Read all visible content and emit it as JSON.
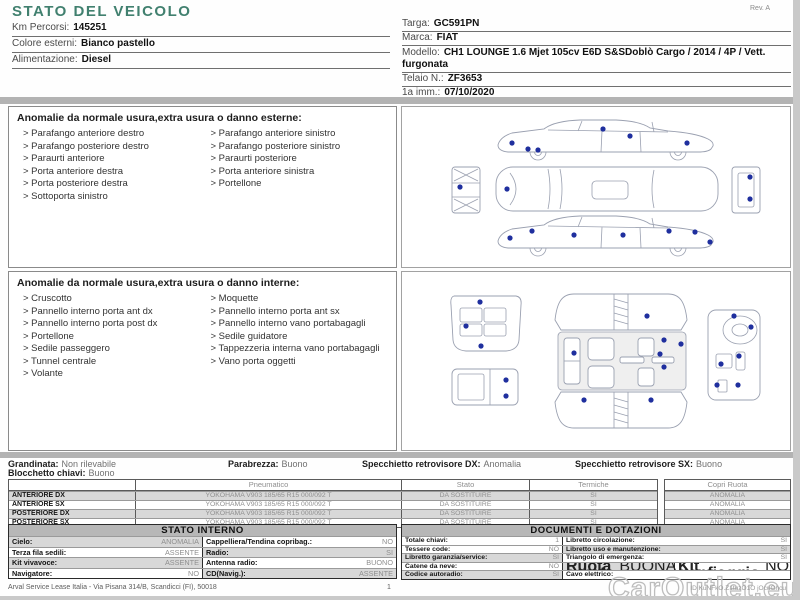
{
  "bullet": ">",
  "title": "STATO DEL VEICOLO",
  "meta": {
    "revision": "Rev. A",
    "footer_company": "Arval Service Lease Italia - Via Pisana 314/B, Scandicci (FI), 50018",
    "page_number": "1",
    "watermark": "CarOutlet.eu",
    "doc_code": "ID KuNFkO.Z1tuzO1O jOcuOhcu"
  },
  "colors": {
    "title_teal": "#41806f",
    "damage_dot": "#1f2f9e",
    "table_header_bg": "#b7b7b7",
    "row_stripe": "#d8d8d8"
  },
  "vehicle_left": [
    {
      "label": "Km Percorsi:",
      "value": "145251"
    },
    {
      "label": "Colore esterni:",
      "value": "Bianco pastello"
    },
    {
      "label": "Alimentazione:",
      "value": "Diesel"
    }
  ],
  "vehicle_right": [
    {
      "label": "Targa:",
      "value": "GC591PN"
    },
    {
      "label": "Marca:",
      "value": "FIAT"
    },
    {
      "label": "Modello:",
      "value": "CH1 LOUNGE 1.6 Mjet 105cv E6D S&SDoblò Cargo / 2014 / 4P / Vett. furgonata"
    },
    {
      "label": "Telaio N.:",
      "value": "ZF3653"
    },
    {
      "label": "1a imm.:",
      "value": "07/10/2020"
    }
  ],
  "exterior_box": {
    "header": "Anomalie da normale usura,extra usura o danno esterne:",
    "left": [
      "Parafango anteriore destro",
      "Parafango posteriore destro",
      "Paraurti anteriore",
      "Porta anteriore destra",
      "Porta posteriore destra",
      "Sottoporta sinistro"
    ],
    "right": [
      "Parafango anteriore sinistro",
      "Parafango posteriore sinistro",
      "Paraurti posteriore",
      "Porta anteriore sinistra",
      "Portellone"
    ]
  },
  "interior_box": {
    "header": "Anomalie da normale usura,extra usura o danno interne:",
    "left": [
      "Cruscotto",
      "Pannello interno porta ant dx",
      "Pannello interno porta post dx",
      "Portellone",
      "Sedile passeggero",
      "Tunnel centrale",
      "Volante"
    ],
    "right": [
      "Moquette",
      "Pannello interno porta ant sx",
      "Pannello interno vano portabagagli",
      "Sedile guidatore",
      "Tappezzeria interna vano portabagagli",
      "Vano porta oggetti"
    ]
  },
  "summary": {
    "grandinata_label": "Grandinata:",
    "grandinata_value": "Non rilevabile",
    "blocchetto_label": "Blocchetto chiavi:",
    "blocchetto_value": "Buono",
    "parabrezza_label": "Parabrezza:",
    "parabrezza_value": "Buono",
    "specchietto_dx_label": "Specchietto retrovisore DX:",
    "specchietto_dx_value": "Anomalia",
    "specchietto_sx_label": "Specchietto retrovisore SX:",
    "specchietto_sx_value": "Buono"
  },
  "tyres": {
    "header_pneumatico": "Pneumatico",
    "header_stato": "Stato",
    "header_termiche": "Termiche",
    "header_copri_ruota": "Copri Ruota",
    "rows": [
      {
        "position": "ANTERIORE DX",
        "tyre": "YOKOHAMA V903 185/65 R15 000/092 T",
        "stato": "DA SOSTITUIRE",
        "termiche": "SI",
        "copri_ruota": "ANOMALIA"
      },
      {
        "position": "ANTERIORE SX",
        "tyre": "YOKOHAMA V903 185/65 R15 000/092 T",
        "stato": "DA SOSTITUIRE",
        "termiche": "SI",
        "copri_ruota": "ANOMALIA"
      },
      {
        "position": "POSTERIORE DX",
        "tyre": "YOKOHAMA V903 185/65 R15 000/092 T",
        "stato": "DA SOSTITUIRE",
        "termiche": "SI",
        "copri_ruota": "ANOMALIA"
      },
      {
        "position": "POSTERIORE SX",
        "tyre": "YOKOHAMA V903 185/65 R15 000/092 T",
        "stato": "DA SOSTITUIRE",
        "termiche": "SI",
        "copri_ruota": "ANOMALIA"
      }
    ]
  },
  "stato_interno": {
    "title": "STATO INTERNO",
    "rows": [
      {
        "l_label": "Cielo:",
        "l_value": "ANOMALIA",
        "r_label": "Cappelliera/Tendina copribag.:",
        "r_value": "NO"
      },
      {
        "l_label": "Terza fila sedili:",
        "l_value": "ASSENTE",
        "r_label": "Radio:",
        "r_value": "SI"
      },
      {
        "l_label": "Kit vivavoce:",
        "l_value": "ASSENTE",
        "r_label": "Antenna radio:",
        "r_value": "BUONO"
      },
      {
        "l_label": "Navigatore:",
        "l_value": "NO",
        "r_label": "CD(Navig.):",
        "r_value": "ASSENTE"
      }
    ]
  },
  "documenti": {
    "title": "DOCUMENTI E DOTAZIONI",
    "rows": [
      {
        "l_label": "Totale chiavi:",
        "l_value": "1",
        "r_label": "Libretto circolazione:",
        "r_value": "SI"
      },
      {
        "l_label": "Tessere code:",
        "l_value": "NO",
        "r_label": "Libretto uso e manutenzione:",
        "r_value": "SI"
      },
      {
        "l_label": "Libretto garanzia/service:",
        "l_value": "SI",
        "r_label": "Triangolo di emergenza:",
        "r_value": "SI"
      },
      {
        "l_label": "Catene da neve:",
        "l_value": "NO",
        "r_label": "Ruota scorta:",
        "r_value": "BUONA",
        "r2_label": "Kit gonfiaggio:",
        "r2_value": "NO"
      },
      {
        "l_label": "Codice autoradio:",
        "l_value": "SI",
        "r_label": "Cavo elettrico:",
        "r_value": ""
      }
    ]
  }
}
